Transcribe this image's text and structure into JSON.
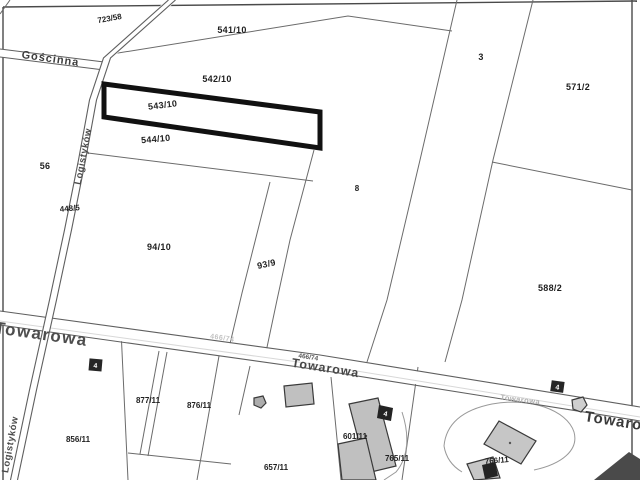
{
  "map": {
    "title": "Cadastral parcel map",
    "streets": {
      "goscinna": "Gościnna",
      "logistykow": "Logistyków",
      "towarowa": "Towarowa"
    },
    "road_numbers": {
      "towarowa_parcel": "466/74"
    },
    "markers": {
      "badge_left": "4",
      "badge_mid": "4",
      "badge_building": "4"
    },
    "highlight": {
      "parcel": "543/10",
      "outline_color": "#111111"
    },
    "colors": {
      "background": "#ffffff",
      "boundary_line": "#6b6b6b",
      "building_fill": "#c0c0c0",
      "dark_area_fill": "#4a4a4a"
    },
    "parcels": {
      "p723_58": "723/58",
      "p541_10": "541/10",
      "p542_10": "542/10",
      "p543_10": "543/10",
      "p544_10": "544/10",
      "p3": "3",
      "p571_2": "571/2",
      "p56": "56",
      "p448_5": "448/5",
      "p94_10": "94/10",
      "p93_9": "93/9",
      "p8": "8",
      "p588_2": "588/2",
      "p877_11": "877/11",
      "p876_11": "876/11",
      "p856_11": "856/11",
      "p657_11": "657/11",
      "p601_11": "601/11",
      "p765_11": "765/11",
      "p766_11": "766/11"
    }
  }
}
